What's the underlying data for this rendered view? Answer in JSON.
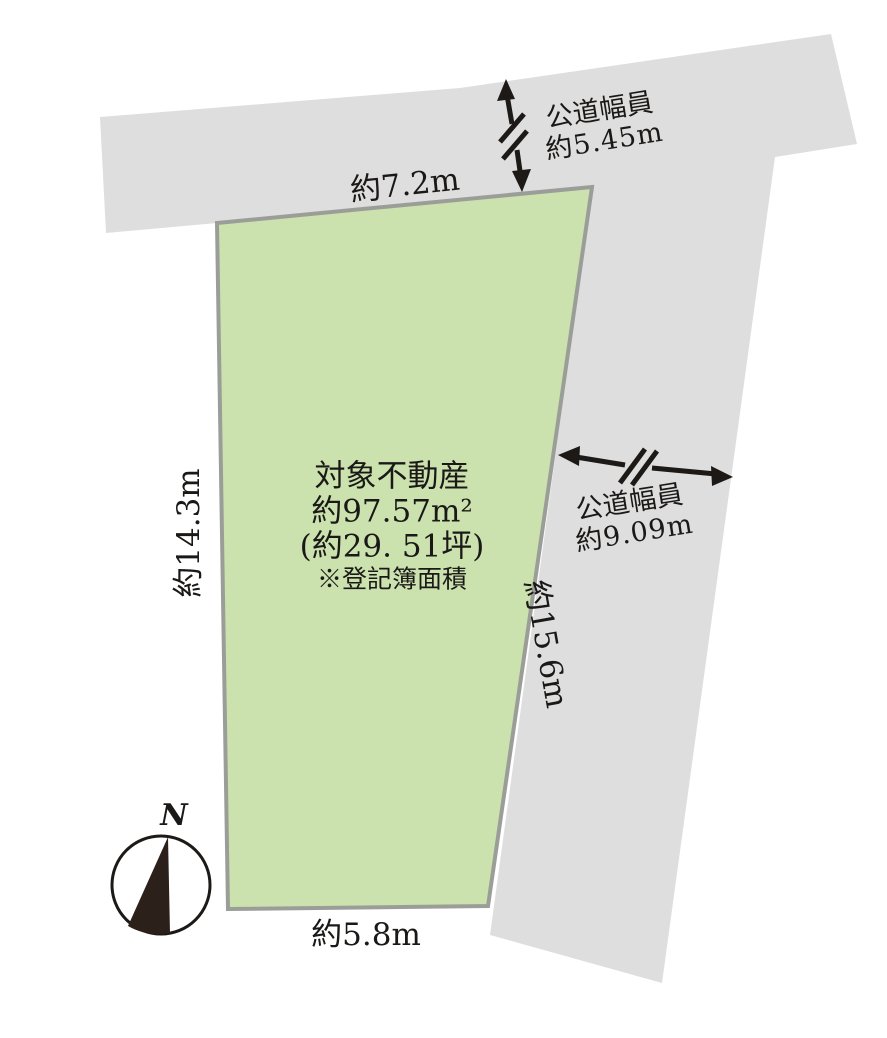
{
  "property": {
    "name": "対象不動産",
    "area_m2": "約97.57m²",
    "area_tsubo": "(約29. 51坪)",
    "area_note": "※登記簿面積"
  },
  "dimensions": {
    "top": "約7.2m",
    "left": "約14.3m",
    "right": "約15.6m",
    "bottom": "約5.8m"
  },
  "roads": {
    "top": {
      "label": "公道幅員",
      "width": "約5.45m"
    },
    "right": {
      "label": "公道幅員",
      "width": "約9.09m"
    }
  },
  "compass": {
    "north": "N"
  },
  "colors": {
    "road": "#dedede",
    "plot_fill": "#cbe2ae",
    "plot_border": "#9b9e98",
    "ink": "#1c1917",
    "compass_fill": "#2b201a"
  }
}
